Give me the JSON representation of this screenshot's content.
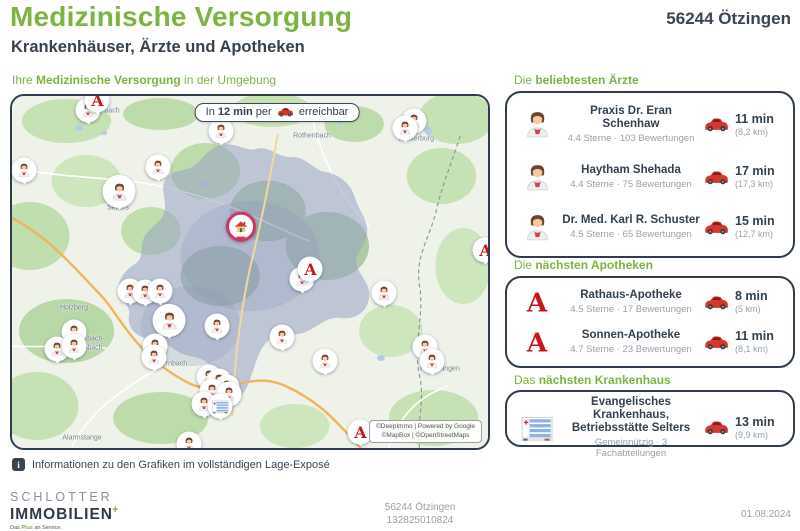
{
  "page": {
    "title": "Medizinische Versorgung",
    "subtitle": "Krankenhäuser, Ärzte und Apotheken",
    "location": "56244 Ötzingen"
  },
  "map": {
    "section_title_prefix": "Ihre ",
    "section_title_bold": "Medizinische Versorgung",
    "section_title_suffix": " in der Umgebung",
    "badge": {
      "prefix": "In ",
      "bold": "12 min",
      "middle": " per ",
      "suffix": " erreichbar"
    },
    "attribution_line1": "©DeepImmo | Powered by Google",
    "attribution_line2": "©MapBox | ©OpenStreetMaps",
    "labels": [
      {
        "text": "bach",
        "x": 100,
        "y": 15
      },
      {
        "text": "Rothenbach",
        "x": 300,
        "y": 40
      },
      {
        "text": "Westerburg",
        "x": 404,
        "y": 43
      },
      {
        "text": "Selters",
        "x": 106,
        "y": 112
      },
      {
        "text": "Holzberg",
        "x": 62,
        "y": 212
      },
      {
        "text": "bach-",
        "x": 84,
        "y": 243
      },
      {
        "text": "mbach",
        "x": 80,
        "y": 252
      },
      {
        "text": "Wirges",
        "x": 158,
        "y": 239
      },
      {
        "text": "Dernbach",
        "x": 160,
        "y": 268
      },
      {
        "text": "Hundsangen",
        "x": 428,
        "y": 273
      },
      {
        "text": "Alarmstange",
        "x": 70,
        "y": 342
      }
    ],
    "markers": [
      {
        "type": "doctor",
        "x": 76,
        "y": 16
      },
      {
        "type": "doctor",
        "x": 209,
        "y": 37
      },
      {
        "type": "doctor",
        "x": 12,
        "y": 76
      },
      {
        "type": "doctor",
        "x": 146,
        "y": 73
      },
      {
        "type": "doctor",
        "x": 107,
        "y": 98,
        "big": true
      },
      {
        "type": "doctor",
        "x": 402,
        "y": 27
      },
      {
        "type": "doctor",
        "x": 393,
        "y": 34
      },
      {
        "type": "doctor",
        "x": 290,
        "y": 185
      },
      {
        "type": "doctor",
        "x": 372,
        "y": 199
      },
      {
        "type": "doctor",
        "x": 118,
        "y": 197
      },
      {
        "type": "doctor",
        "x": 133,
        "y": 198
      },
      {
        "type": "doctor",
        "x": 148,
        "y": 197
      },
      {
        "type": "doctor",
        "x": 157,
        "y": 227,
        "big": true
      },
      {
        "type": "doctor",
        "x": 205,
        "y": 232
      },
      {
        "type": "doctor",
        "x": 270,
        "y": 243
      },
      {
        "type": "doctor",
        "x": 62,
        "y": 238
      },
      {
        "type": "doctor",
        "x": 45,
        "y": 255
      },
      {
        "type": "doctor",
        "x": 62,
        "y": 252
      },
      {
        "type": "doctor",
        "x": 143,
        "y": 252
      },
      {
        "type": "doctor",
        "x": 142,
        "y": 263
      },
      {
        "type": "doctor",
        "x": 313,
        "y": 267
      },
      {
        "type": "doctor",
        "x": 413,
        "y": 253
      },
      {
        "type": "doctor",
        "x": 420,
        "y": 267
      },
      {
        "type": "doctor",
        "x": 197,
        "y": 283
      },
      {
        "type": "doctor",
        "x": 207,
        "y": 287
      },
      {
        "type": "doctor",
        "x": 215,
        "y": 293
      },
      {
        "type": "doctor",
        "x": 200,
        "y": 297
      },
      {
        "type": "doctor",
        "x": 192,
        "y": 310
      },
      {
        "type": "doctor",
        "x": 217,
        "y": 300
      },
      {
        "type": "doctor",
        "x": 177,
        "y": 350
      },
      {
        "type": "pharmacy",
        "x": 85,
        "y": 6
      },
      {
        "type": "pharmacy",
        "x": 298,
        "y": 175
      },
      {
        "type": "pharmacy",
        "x": 473,
        "y": 156
      },
      {
        "type": "pharmacy",
        "x": 348,
        "y": 338
      },
      {
        "type": "hospital",
        "x": 208,
        "y": 312
      },
      {
        "type": "home",
        "x": 229,
        "y": 133
      }
    ]
  },
  "sections": {
    "doctors": {
      "title_prefix": "Die ",
      "title_bold": "beliebtesten Ärzte",
      "items": [
        {
          "name": "Praxis Dr. Eran Schenhaw",
          "rating": "4.4 Sterne · 103 Bewertungen",
          "time": "11 min",
          "distance": "(8,2 km)"
        },
        {
          "name": "Haytham Shehada",
          "rating": "4.4 Sterne · 75 Bewertungen",
          "time": "17 min",
          "distance": "(17,3 km)"
        },
        {
          "name": "Dr. Med. Karl R. Schuster",
          "rating": "4.5 Sterne · 65 Bewertungen",
          "time": "15 min",
          "distance": "(12,7 km)"
        }
      ]
    },
    "pharmacies": {
      "title_prefix": "Die ",
      "title_bold": "nächsten Apotheken",
      "items": [
        {
          "name": "Rathaus-Apotheke",
          "rating": "4.5 Sterne · 17 Bewertungen",
          "time": "8 min",
          "distance": "(5 km)"
        },
        {
          "name": "Sonnen-Apotheke",
          "rating": "4.7 Sterne · 23 Bewertungen",
          "time": "11 min",
          "distance": "(8,1 km)"
        }
      ]
    },
    "hospital": {
      "title_prefix": "Das ",
      "title_bold": "nächsten Krankenhaus",
      "items": [
        {
          "name": "Evangelisches Krankenhaus, Betriebsstätte Selters",
          "rating": "Gemeinnützig · 3 Fachabteilungen",
          "time": "13 min",
          "distance": "(9,9 km)"
        }
      ]
    }
  },
  "footer": {
    "info_note": "Informationen zu den Grafiken im vollständigen Lage-Exposé",
    "logo_line1": "SCHLOTTER",
    "logo_line2": "IMMOBILIEN",
    "logo_plus": "+",
    "tagline_prefix": "Das ",
    "tagline_green": "Plus",
    "tagline_suffix": " an Service.",
    "center_line1": "56244 Ötzingen",
    "center_line2": "132825010824",
    "date": "01.08.2024"
  },
  "colors": {
    "accent_green": "#7cb342",
    "navy": "#2e3c4c",
    "red": "#c4161c",
    "isochrone": "#98a3c4",
    "gray_text": "#9aa0a6"
  }
}
